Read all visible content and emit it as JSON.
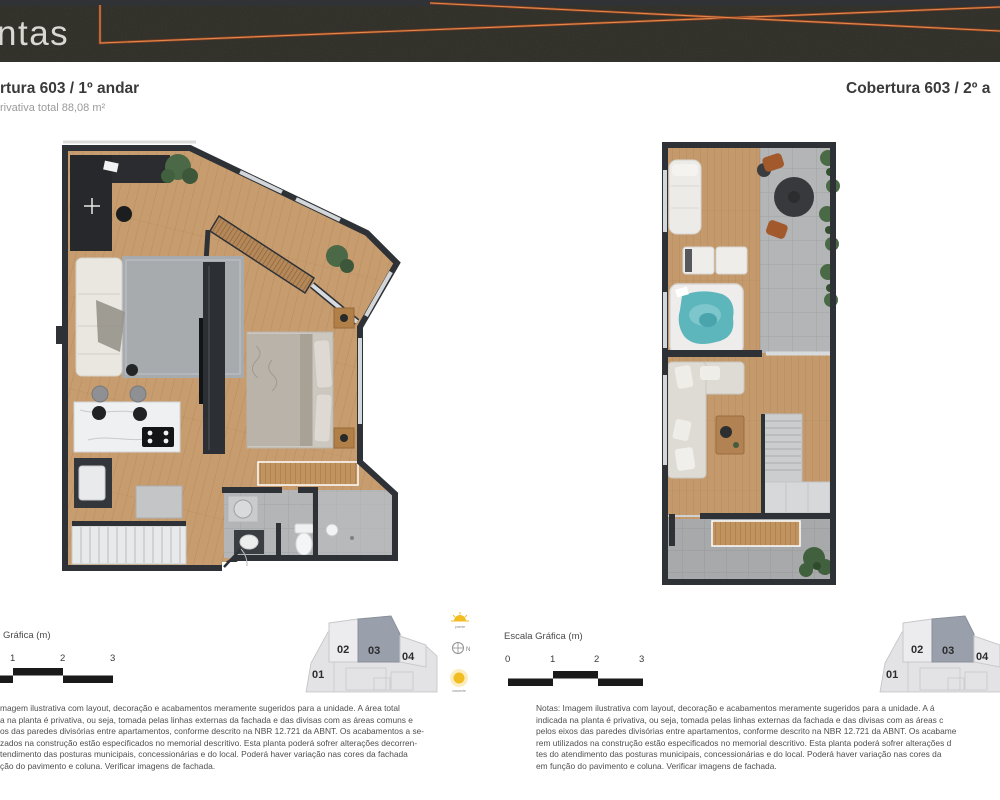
{
  "header": {
    "brand_fragment": "ntas"
  },
  "plans": [
    {
      "title": "rtura 603 / 1º andar",
      "subtitle": "rivativa total 88,08 m²"
    },
    {
      "title": "Cobertura 603 / 2º a"
    }
  ],
  "scales": {
    "left": {
      "label": "Gráfica (m)",
      "ticks": [
        "1",
        "2",
        "3"
      ]
    },
    "right": {
      "label": "Escala Gráfica (m)",
      "ticks": [
        "0",
        "1",
        "2",
        "3"
      ]
    }
  },
  "keyplan": {
    "units": [
      "01",
      "02",
      "03",
      "04"
    ],
    "highlighted_unit": "03"
  },
  "orientation": {
    "compass_label": "N",
    "sun_top_label": "poente",
    "sun_bottom_label": "nascente"
  },
  "notes_left": {
    "lines": [
      "magem ilustrativa com layout, decoração e acabamentos meramente sugeridos para a unidade. A área total",
      "a na planta é privativa, ou seja, tomada pelas linhas externas da fachada e das divisas com as áreas comuns e",
      "os das paredes divisórias entre apartamentos, conforme descrito na NBR 12.721 da ABNT. Os acabamentos a se-",
      "zados na construção estão especificados no memorial descritivo. Esta planta poderá sofrer alterações decorren-",
      "tendimento das posturas municipais, concessionárias e do local. Poderá haver variação nas cores da fachada",
      "ção do pavimento e coluna. Verificar imagens de fachada."
    ]
  },
  "notes_right": {
    "lines": [
      "Notas: Imagem ilustrativa com layout, decoração e acabamentos meramente sugeridos para a unidade. A á",
      "indicada na planta é privativa, ou seja, tomada pelas linhas externas da fachada e das divisas com as áreas c",
      "pelos eixos das paredes divisórias entre apartamentos, conforme descrito na NBR 12.721 da ABNT. Os acabame",
      "rem utilizados na construção estão especificados no memorial descritivo. Esta planta poderá sofrer alterações d",
      "tes do atendimento das posturas municipais, concessionárias e do local. Poderá haver variação nas cores da",
      "em função do pavimento e coluna. Verificar imagens de fachada."
    ]
  },
  "colors": {
    "header_concrete": "#3f3e36",
    "accent_orange": "#c06134",
    "wall": "#2e3237",
    "wood": "#c59a6b",
    "tile": "#b1b3b5",
    "rug": "#a7abae",
    "jacuzzi": "#5cb6bc",
    "keyplan_highlight": "#9aa0ab",
    "sun": "#f2bd23"
  }
}
